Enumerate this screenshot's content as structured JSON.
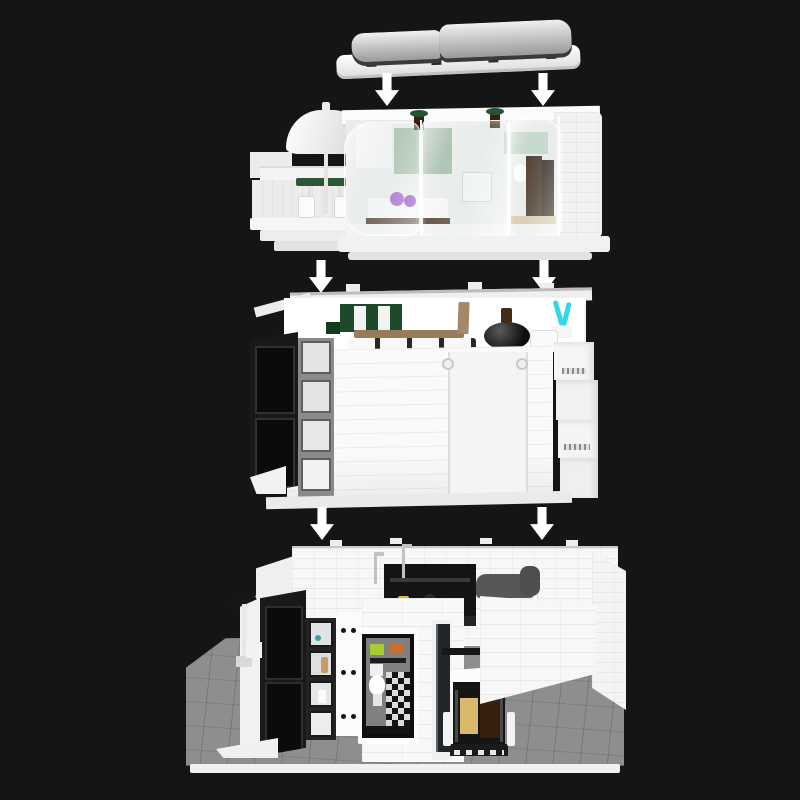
{
  "scene": {
    "background": "#151515",
    "subject": "exploded-view-of-white-modular-brick-house",
    "sections": [
      {
        "id": "roof",
        "label": "roof-panel"
      },
      {
        "id": "upper-floor",
        "label": "terrace-with-parasol-and-glass-bedroom"
      },
      {
        "id": "middle-floor",
        "label": "living-room-and-kitchen-level"
      },
      {
        "id": "ground-floor",
        "label": "bathroom-and-wardrobe-level-on-baseplate"
      }
    ],
    "arrows": {
      "count": 6,
      "direction": "down"
    }
  },
  "palette": {
    "background": "#151515",
    "arrow": "#ffffff",
    "plastic_white": "#f4f4f4",
    "roof_gray": "#c2c2c2",
    "roof_edge": "#3a3a3a",
    "frame_black": "#191919",
    "pane_black": "#0b0b0b",
    "window_gray": "#8a8a8a",
    "kitchen_green": "#1d4a2b",
    "sage_green": "#a3bca6",
    "sage_light": "#bdd3c1",
    "bar_brown": "#9a7a5c",
    "plank_brown": "#a5876a",
    "dark_brown": "#37200f",
    "bed_base_brown": "#52392a",
    "pillow_purple": "#9c4fc4",
    "pillow_purple_dark": "#8a3fb4",
    "plant_cyan": "#35d6ec",
    "towel_lime": "#a7cb32",
    "towel_orange": "#c96f2f",
    "wardrobe_gold": "#d9b869",
    "baseplate_gray": "#8e8e8e",
    "sofa_gray": "#575757",
    "parasol_table_green": "#2c5737",
    "terrace_plant_green": "#275233",
    "kitchen_yellow": "#d6be2e",
    "chrome": "#bfc3c6",
    "teal_item": "#2fa8a0",
    "tan_figure": "#c79c62"
  }
}
